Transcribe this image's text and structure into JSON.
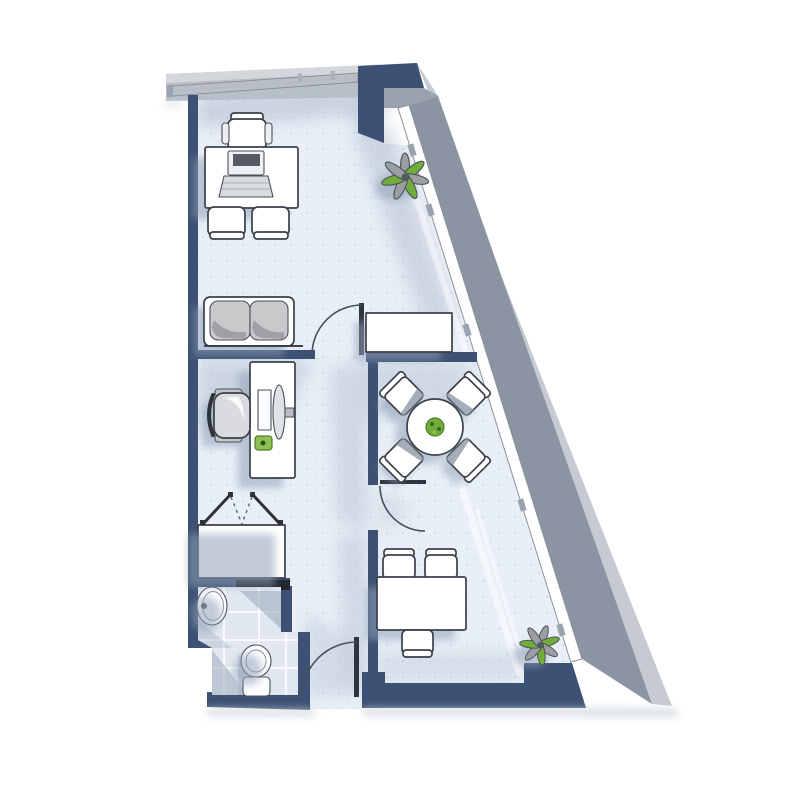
{
  "meta": {
    "title": "Apartment floor plan",
    "image_type": "architectural floor plan, top-down rendered drawing",
    "canvas_width": 800,
    "canvas_height": 803,
    "background": "#ffffff",
    "visible_text": "none"
  },
  "palette": {
    "wall_navy": "#3c5173",
    "wall_navy_dark": "#2f405d",
    "lintel_dark": "#23272e",
    "slab_gray": "#b9bfc8",
    "slab_highlight": "#d3d6db",
    "wall_gray_dark": "#8b94a3",
    "wall_gray_light": "#c6cad2",
    "notch_gray": "#9aa2af",
    "floor": "#e9eff7",
    "floor_speckle": "#cfd9e8",
    "tile": "#e2e8f1",
    "shadow_soft": "#a8b6ca",
    "shadow_furniture": "#8fa0b7",
    "window_white": "#ffffff",
    "furniture_white": "#ffffff",
    "cushion_gray": "#c9c9cc",
    "cushion_shade": "#9a9aa0",
    "monitor_gray": "#dfe2e7",
    "keyboard_green": "#8fbf52",
    "plant_green": "#71ad3b",
    "plant_gray": "#9b9ea3",
    "plant_center": "#565b63"
  },
  "plan": {
    "style": "hand-drawn style plan, navy interior walls, gray exterior slab walls, diagonal glazed facade on the right",
    "rooms": [
      {
        "name": "main-office",
        "position": "top",
        "contents": [
          "desk with laptop",
          "three chairs",
          "sofa",
          "sideboard",
          "plant"
        ]
      },
      {
        "name": "work-nook",
        "position": "middle-left",
        "contents": [
          "computer desk",
          "office chair",
          "monitor",
          "keyboard"
        ]
      },
      {
        "name": "dining-room",
        "position": "middle-right",
        "contents": [
          "round table",
          "four chairs",
          "table plant"
        ]
      },
      {
        "name": "lower-office",
        "position": "bottom-right",
        "contents": [
          "desk",
          "three chairs",
          "plant"
        ]
      },
      {
        "name": "bathroom",
        "position": "bottom-left",
        "contents": [
          "washbasin",
          "toilet",
          "tiled floor"
        ]
      },
      {
        "name": "closet",
        "position": "left",
        "contents": [
          "wardrobe with double doors"
        ]
      },
      {
        "name": "hallway",
        "position": "center",
        "contents": []
      }
    ],
    "windows": [
      {
        "name": "top-window",
        "wall": "north",
        "segments": 2
      },
      {
        "name": "facade-window",
        "wall": "diagonal-east",
        "segments": 5
      }
    ],
    "doors": [
      {
        "name": "hallway-door",
        "swing": "quarter-arc"
      },
      {
        "name": "dining-door",
        "swing": "quarter-arc"
      },
      {
        "name": "bathroom-door",
        "swing": "quarter-arc"
      },
      {
        "name": "entrance-door",
        "swing": "quarter-arc"
      },
      {
        "name": "closet-double-doors",
        "swing": "double-leaf dashed"
      }
    ],
    "furniture_counts": {
      "desks": 3,
      "chairs": 11,
      "sofas": 1,
      "tables": 1,
      "plants": 3,
      "sideboards": 1,
      "wardrobes": 1
    },
    "fixtures": [
      "washbasin",
      "toilet"
    ]
  }
}
